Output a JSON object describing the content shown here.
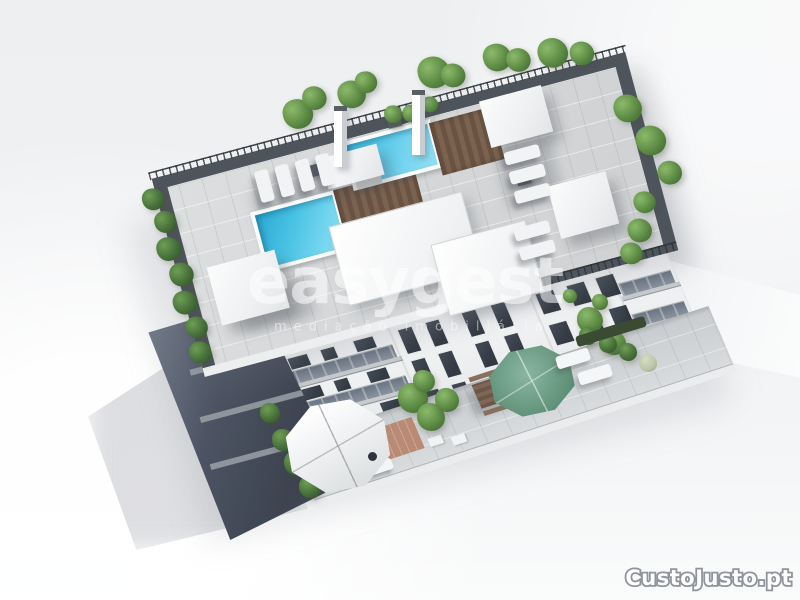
{
  "meta": {
    "kind": "real-estate-3d-render",
    "description": "Aerial 3D architectural render of a modern white apartment building with two rooftop pools, wood decks, sun loungers, canopies, perimeter hedges and ground-floor terraces with parasols"
  },
  "watermarks": {
    "agency_name": "easygest",
    "agency_tagline": "mediação imobiliária",
    "site_logo": "CustoJusto.pt"
  },
  "palette": {
    "background": "#f0f1f3",
    "roof_tiles": "#d5d7d8",
    "parapet_gray": "#4e545b",
    "pool_water": "#49c2e4",
    "pool_water_deep": "#2ba8d2",
    "wood_deck": "#75604c",
    "hedge_green": "#5d8a44",
    "parasol_green": "#67987f",
    "facade_white": "#f4f5f6",
    "window_glass": "#39404a",
    "shaded_side": "#434a57",
    "watermark_white": "rgba(255,255,255,0.55)",
    "logo_fill": "#ffffff",
    "logo_outline": "#8f959a"
  },
  "scene": {
    "rooftop_features": [
      "swimming-pool-main",
      "swimming-pool-secondary",
      "wood-decks",
      "sun-loungers",
      "white-canopies",
      "perimeter-hedges",
      "railings",
      "chimneys"
    ],
    "ground_features": [
      "white-parasol-patio",
      "green-parasol",
      "outdoor-dining-table",
      "hedge-planters",
      "sun-loungers"
    ]
  }
}
